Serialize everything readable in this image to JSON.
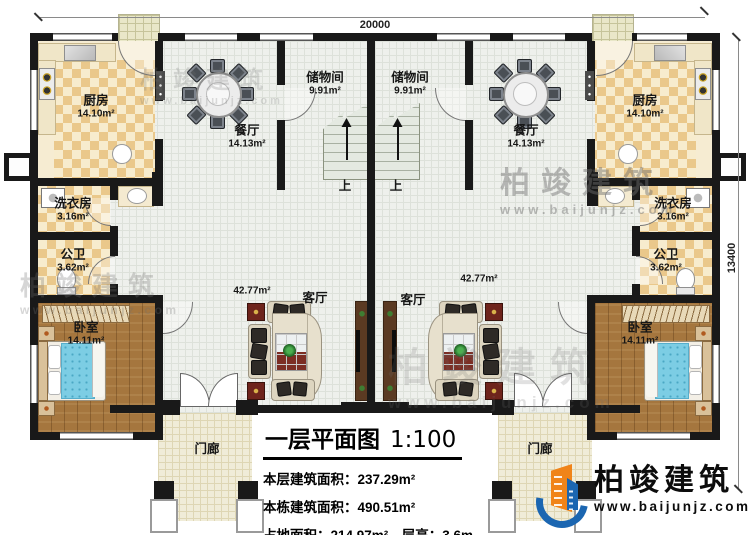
{
  "drawing": {
    "title": "一层平面图",
    "scale": "1:100",
    "info_lines": [
      "本层建筑面积：237.29m²",
      "本栋建筑面积：490.51m²",
      "占地面积：214.97m²　层高：3.6m"
    ]
  },
  "dims": {
    "width": "20000",
    "height": "13400"
  },
  "stairs": {
    "up_label": "上"
  },
  "rooms": {
    "kitchen_left": {
      "name": "厨房",
      "area": "14.10m²"
    },
    "kitchen_right": {
      "name": "厨房",
      "area": "14.10m²"
    },
    "storage_left": {
      "name": "储物间",
      "area": "9.91m²"
    },
    "storage_right": {
      "name": "储物间",
      "area": "9.91m²"
    },
    "dining_left": {
      "name": "餐厅",
      "area": "14.13m²"
    },
    "dining_right": {
      "name": "餐厅",
      "area": "14.13m²"
    },
    "laundry_left": {
      "name": "洗衣房",
      "area": "3.16m²"
    },
    "laundry_right": {
      "name": "洗衣房",
      "area": "3.16m²"
    },
    "bath_left": {
      "name": "公卫",
      "area": "3.62m²"
    },
    "bath_right": {
      "name": "公卫",
      "area": "3.62m²"
    },
    "bedroom_left": {
      "name": "卧室",
      "area": "14.11m²"
    },
    "bedroom_right": {
      "name": "卧室",
      "area": "14.11m²"
    },
    "living_left": {
      "name": "客厅",
      "area": "42.77m²"
    },
    "living_right": {
      "name": "客厅",
      "area": "42.77m²"
    },
    "porch_left": {
      "name": "门廊"
    },
    "porch_right": {
      "name": "门廊"
    }
  },
  "watermark": {
    "brand": "柏竣建筑",
    "url": "www.baijunjz.com"
  },
  "logo": {
    "brand": "柏竣建筑",
    "url": "www.baijunjz.com"
  },
  "colors": {
    "wall": "#191919",
    "brand_blue": "#1b66b1",
    "brand_orange": "#f08419",
    "bed": "#7ccde4",
    "rug": "#7c2e24"
  }
}
